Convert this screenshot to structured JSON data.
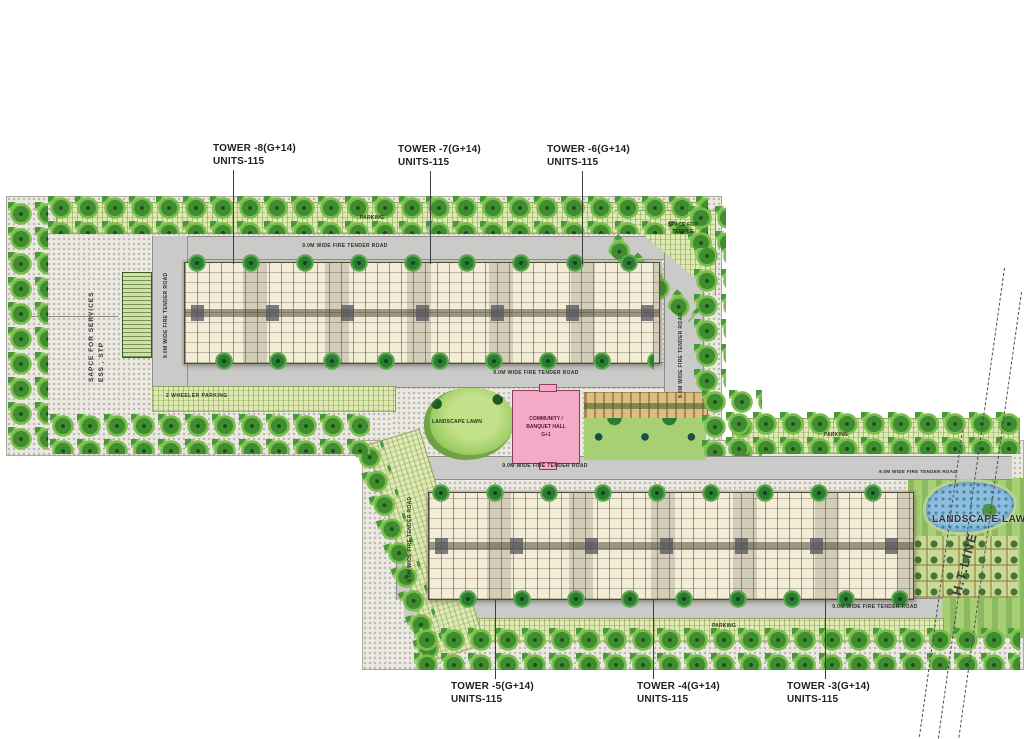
{
  "towers": {
    "top": [
      {
        "name": "TOWER -8(G+14)",
        "units": "UNITS-115"
      },
      {
        "name": "TOWER -7(G+14)",
        "units": "UNITS-115"
      },
      {
        "name": "TOWER -6(G+14)",
        "units": "UNITS-115"
      }
    ],
    "bottom": [
      {
        "name": "TOWER -5(G+14)",
        "units": "UNITS-115"
      },
      {
        "name": "TOWER -4(G+14)",
        "units": "UNITS-115"
      },
      {
        "name": "TOWER -3(G+14)",
        "units": "UNITS-115"
      }
    ]
  },
  "roads": {
    "fire_tender_label": "9.0M WIDE FIRE TENDER ROAD"
  },
  "labels": {
    "services_line1": "SAPCE FOR SERVICES",
    "services_line2": "ESS , STP",
    "space_for_temple": "SPACE FOR TEMPLE",
    "parking": "PARKING",
    "two_wheeler_parking": "2 WHEELER PARKING",
    "landscape_lawn": "LANDSCAPE LAWN",
    "community": {
      "line1": "COMMUNITY /",
      "line2": "BANQUET HALL",
      "line3": "G+1"
    },
    "ht_line": "H.T.LINE"
  },
  "colors": {
    "building": "#f3edd8",
    "community_block": "#f3aac6",
    "road": "#cacac8",
    "tree": "#3f8c31",
    "lawn": "#a6d073",
    "pond": "#8abfdd",
    "hatch_strip": "#dfe9b6"
  }
}
